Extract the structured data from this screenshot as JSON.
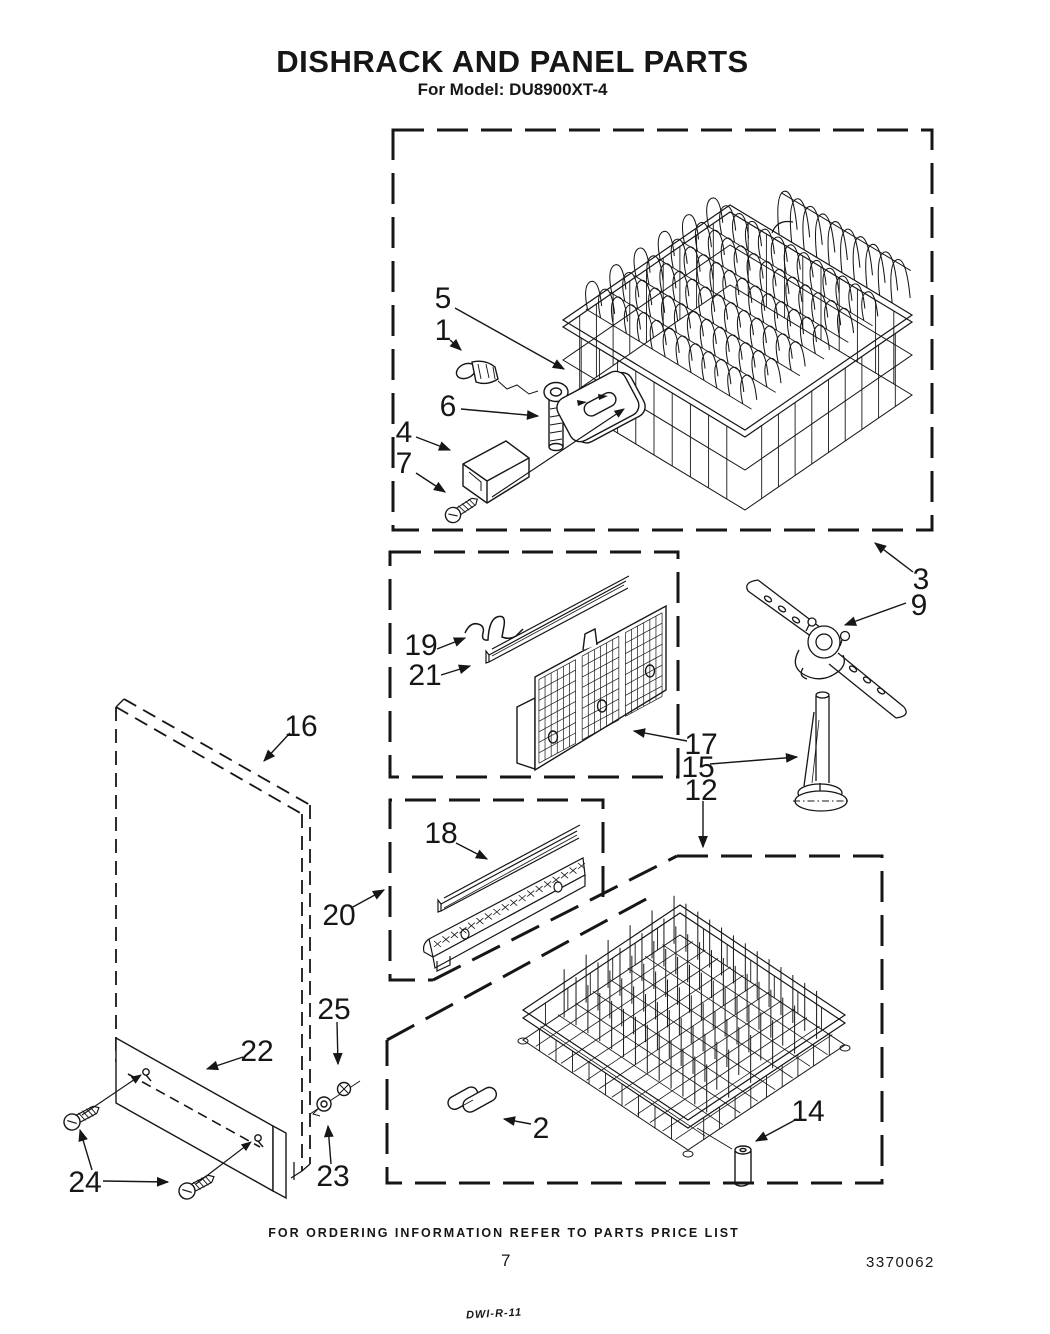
{
  "header": {
    "title": "DISHRACK AND PANEL PARTS",
    "model_line": "For Model: DU8900XT-4"
  },
  "diagram": {
    "callouts": [
      {
        "label": "5"
      },
      {
        "label": "1"
      },
      {
        "label": "6"
      },
      {
        "label": "4"
      },
      {
        "label": "7"
      },
      {
        "label": "3"
      },
      {
        "label": "9"
      },
      {
        "label": "19"
      },
      {
        "label": "21"
      },
      {
        "label": "17"
      },
      {
        "label": "15"
      },
      {
        "label": "12"
      },
      {
        "label": "16"
      },
      {
        "label": "20"
      },
      {
        "label": "18"
      },
      {
        "label": "22"
      },
      {
        "label": "24"
      },
      {
        "label": "25"
      },
      {
        "label": "23"
      },
      {
        "label": "2"
      },
      {
        "label": "14"
      }
    ]
  },
  "footer": {
    "ordering_note": "FOR ORDERING INFORMATION REFER TO PARTS PRICE LIST",
    "page_number": "7",
    "document_number": "3370062",
    "handwritten_note": "DWI-R-11"
  }
}
